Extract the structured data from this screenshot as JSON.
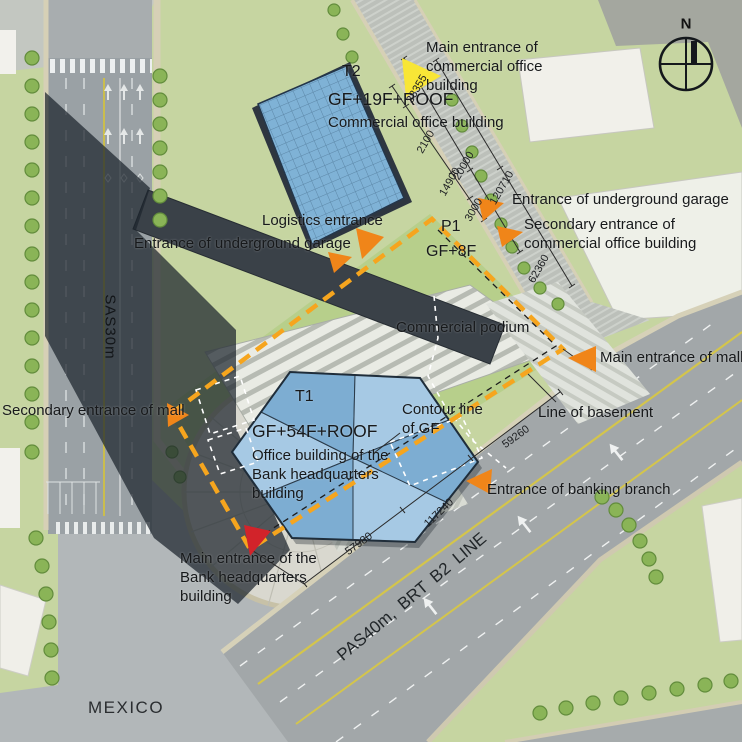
{
  "compass": {
    "north_label": "N"
  },
  "district_label": "MEXICO",
  "roads": {
    "west_road": "SAS30m",
    "south_road": "PAS40m, BRT B2 LINE"
  },
  "buildings": {
    "t2": {
      "code": "T2",
      "floors": "GF+19F+ROOF",
      "name": "Commercial office building"
    },
    "t1": {
      "code": "T1",
      "floors": "GF+54F+ROOF",
      "name": "Office building of the Bank headquarters building"
    },
    "podium": {
      "code": "P1",
      "floors": "GF+8F",
      "name": "Commercial podium"
    }
  },
  "entrances": {
    "main_office": {
      "label": "Main entrance of commercial office building",
      "marker": "yellow"
    },
    "logistics": {
      "label": "Logistics entrance",
      "marker": "orange"
    },
    "garage_west": {
      "label": "Entrance of underground garage",
      "marker": "orange"
    },
    "garage_east": {
      "label": "Entrance of underground garage",
      "marker": "orange"
    },
    "secondary_office": {
      "label": "Secondary entrance of commercial office building",
      "marker": "orange"
    },
    "main_mall": {
      "label": "Main entrance of mall",
      "marker": "orange"
    },
    "secondary_mall": {
      "label": "Secondary entrance of mall",
      "marker": "orange"
    },
    "banking_branch": {
      "label": "Entrance of banking branch",
      "marker": "orange"
    },
    "main_bank": {
      "label": "Main entrance of the Bank headquarters building",
      "marker": "red"
    }
  },
  "annotations": {
    "contour_gf": "Contour line of GF",
    "line_basement": "Line of basement"
  },
  "dimensions": {
    "north_road": [
      "38355",
      "2100",
      "20000",
      "14900",
      "120710",
      "3000",
      "62360"
    ],
    "south_road": [
      "59260",
      "117240",
      "57980"
    ]
  },
  "colors": {
    "entrance_orange": "#f08519",
    "entrance_yellow": "#f8e636",
    "entrance_main_red": "#d2232a",
    "basement_boundary_orange": "#f6a51e",
    "tower_blue": "#7fb2d6"
  }
}
